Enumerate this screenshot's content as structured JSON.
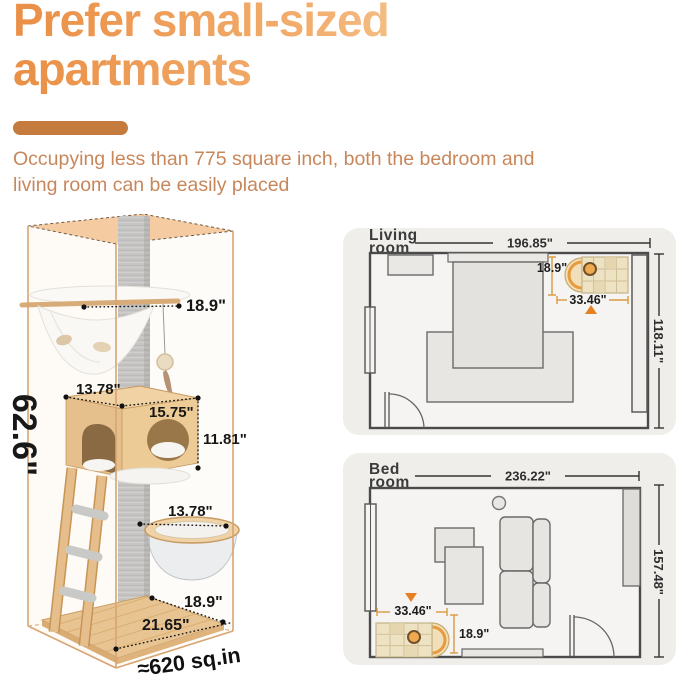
{
  "header": {
    "title_line1": "Prefer small-sized",
    "title_line2": "apartments",
    "subtitle_line1": "Occupying less than 775 square inch, both the bedroom and",
    "subtitle_line2": "living room can be easily placed"
  },
  "cat_tree": {
    "overall_height": "62.6\"",
    "top_perch_width": "18.9\"",
    "condo_depth": "13.78\"",
    "condo_width": "15.75\"",
    "condo_height": "11.81\"",
    "bowl_diameter": "13.78\"",
    "base_depth": "18.9\"",
    "base_width": "21.65\"",
    "footprint": "≈620 sq.in"
  },
  "living_room": {
    "name_line1": "Living",
    "name_line2": "room",
    "room_width": "196.85\"",
    "room_depth": "118.11\"",
    "tree_depth": "18.9\"",
    "tree_width": "33.46\""
  },
  "bedroom": {
    "name_line1": "Bed",
    "name_line2": "room",
    "room_width": "236.22\"",
    "room_depth": "157.48\"",
    "tree_width": "33.46\"",
    "tree_depth": "18.9\""
  },
  "colors": {
    "accent_orange": "#C57B3E",
    "subtitle_orange": "#C8875B",
    "heading_gradient_start": "#EA8F46",
    "heading_gradient_end": "#F9D6AA",
    "dimension_line_orange": "#D9993F",
    "marker_orange": "#E67E22",
    "box_edge_tan": "#D8A473",
    "box_top_peach": "#F5CBA1",
    "wood": "#E8C493",
    "post_gray": "#C7C6C4",
    "card_background": "#EFEEEB",
    "wall_gray": "#4A4A4A"
  }
}
